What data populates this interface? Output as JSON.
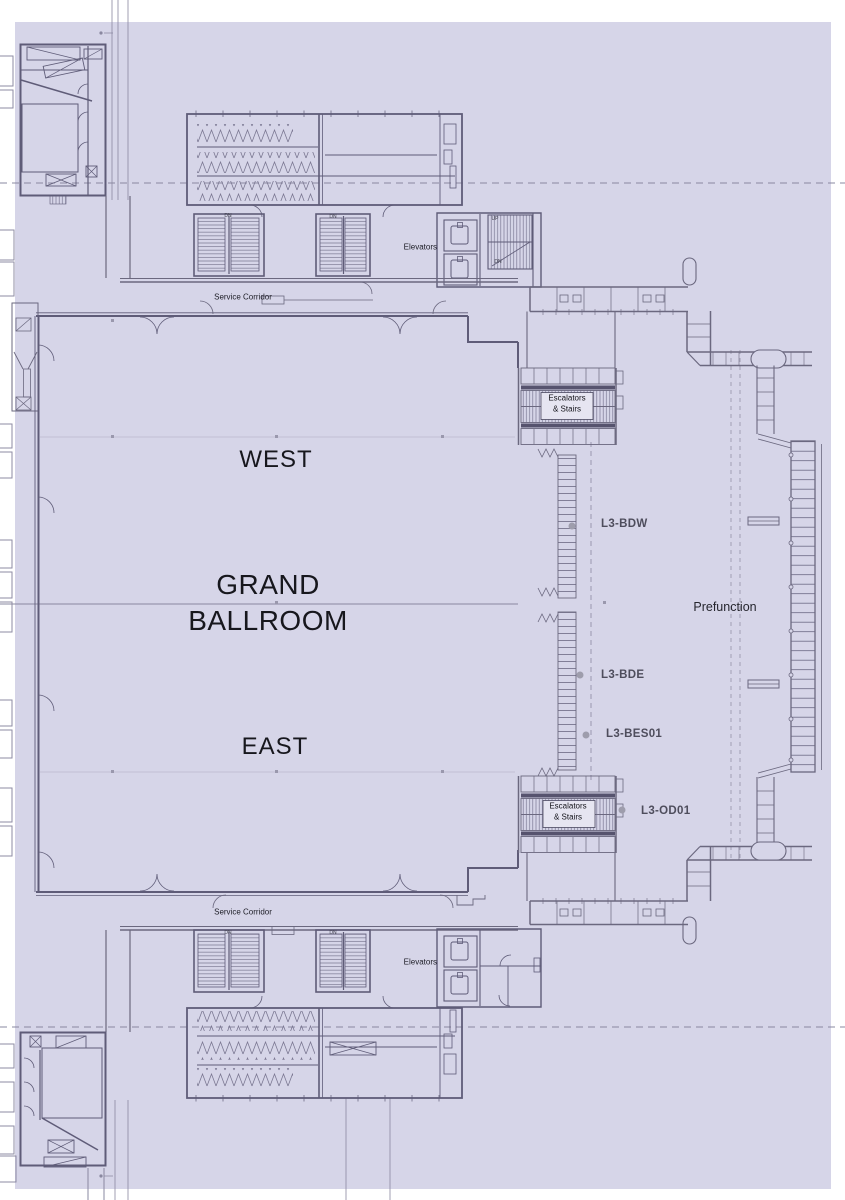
{
  "colors": {
    "floor": "#d6d5e8",
    "line": "#716e8a",
    "wall": "#5f5c78",
    "line_dark": "#56536e",
    "dash": "#8a88a0",
    "text": "#17171d",
    "code_text": "#4e4d5c",
    "dot": "#9e9dac"
  },
  "ballroom": {
    "title_line1": "GRAND",
    "title_line2": "BALLROOM",
    "west": "WEST",
    "east": "EAST"
  },
  "areas": {
    "prefunction": "Prefunction",
    "service_corridor": "Service Corridor",
    "elevators": "Elevators",
    "escalators_line1": "Escalators",
    "escalators_line2": "& Stairs"
  },
  "stairs": {
    "up": "UP",
    "dn": "DN"
  },
  "points": [
    {
      "id": "L3-BDW"
    },
    {
      "id": "L3-BDE"
    },
    {
      "id": "L3-BES01"
    },
    {
      "id": "L3-OD01"
    }
  ]
}
